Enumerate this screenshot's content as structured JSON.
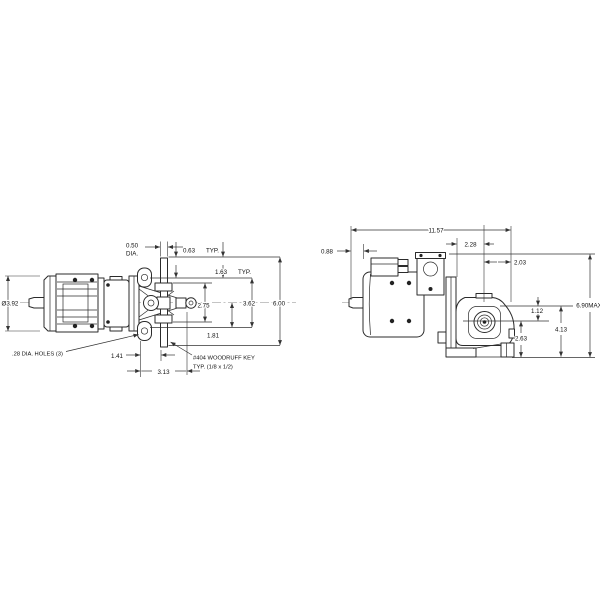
{
  "drawing": {
    "type": "dimensioned engineering drawing, two orthographic views of a motor-driven pump unit",
    "colors": {
      "background": "#ffffff",
      "line": "#2b2b2b",
      "text": "#111111"
    },
    "top": {
      "dia_body": "Ø3.92",
      "holes_note": ".28 DIA. HOLES (3)",
      "shaft_dia_value": "0.50",
      "shaft_dia_suffix": "DIA.",
      "offset_063": "0.63",
      "typ_063": "TYP.",
      "offset_163": "1.63",
      "typ_163": "TYP.",
      "span_275": "2.75",
      "span_362": "3.62",
      "span_600": "6.00",
      "span_181": "1.81",
      "span_141": "1.41",
      "span_313": "3.13",
      "key_note_1": "#404 WOODRUFF KEY",
      "key_note_2": "TYP. (1/8 x 1/2)"
    },
    "side": {
      "length_1157": "11.57",
      "shaft_088": "0.88",
      "span_228": "2.28",
      "span_203": "2.03",
      "height_690": "6.90MAX",
      "span_112": "1.12",
      "span_413": "4.13",
      "span_263": "2.63"
    }
  }
}
